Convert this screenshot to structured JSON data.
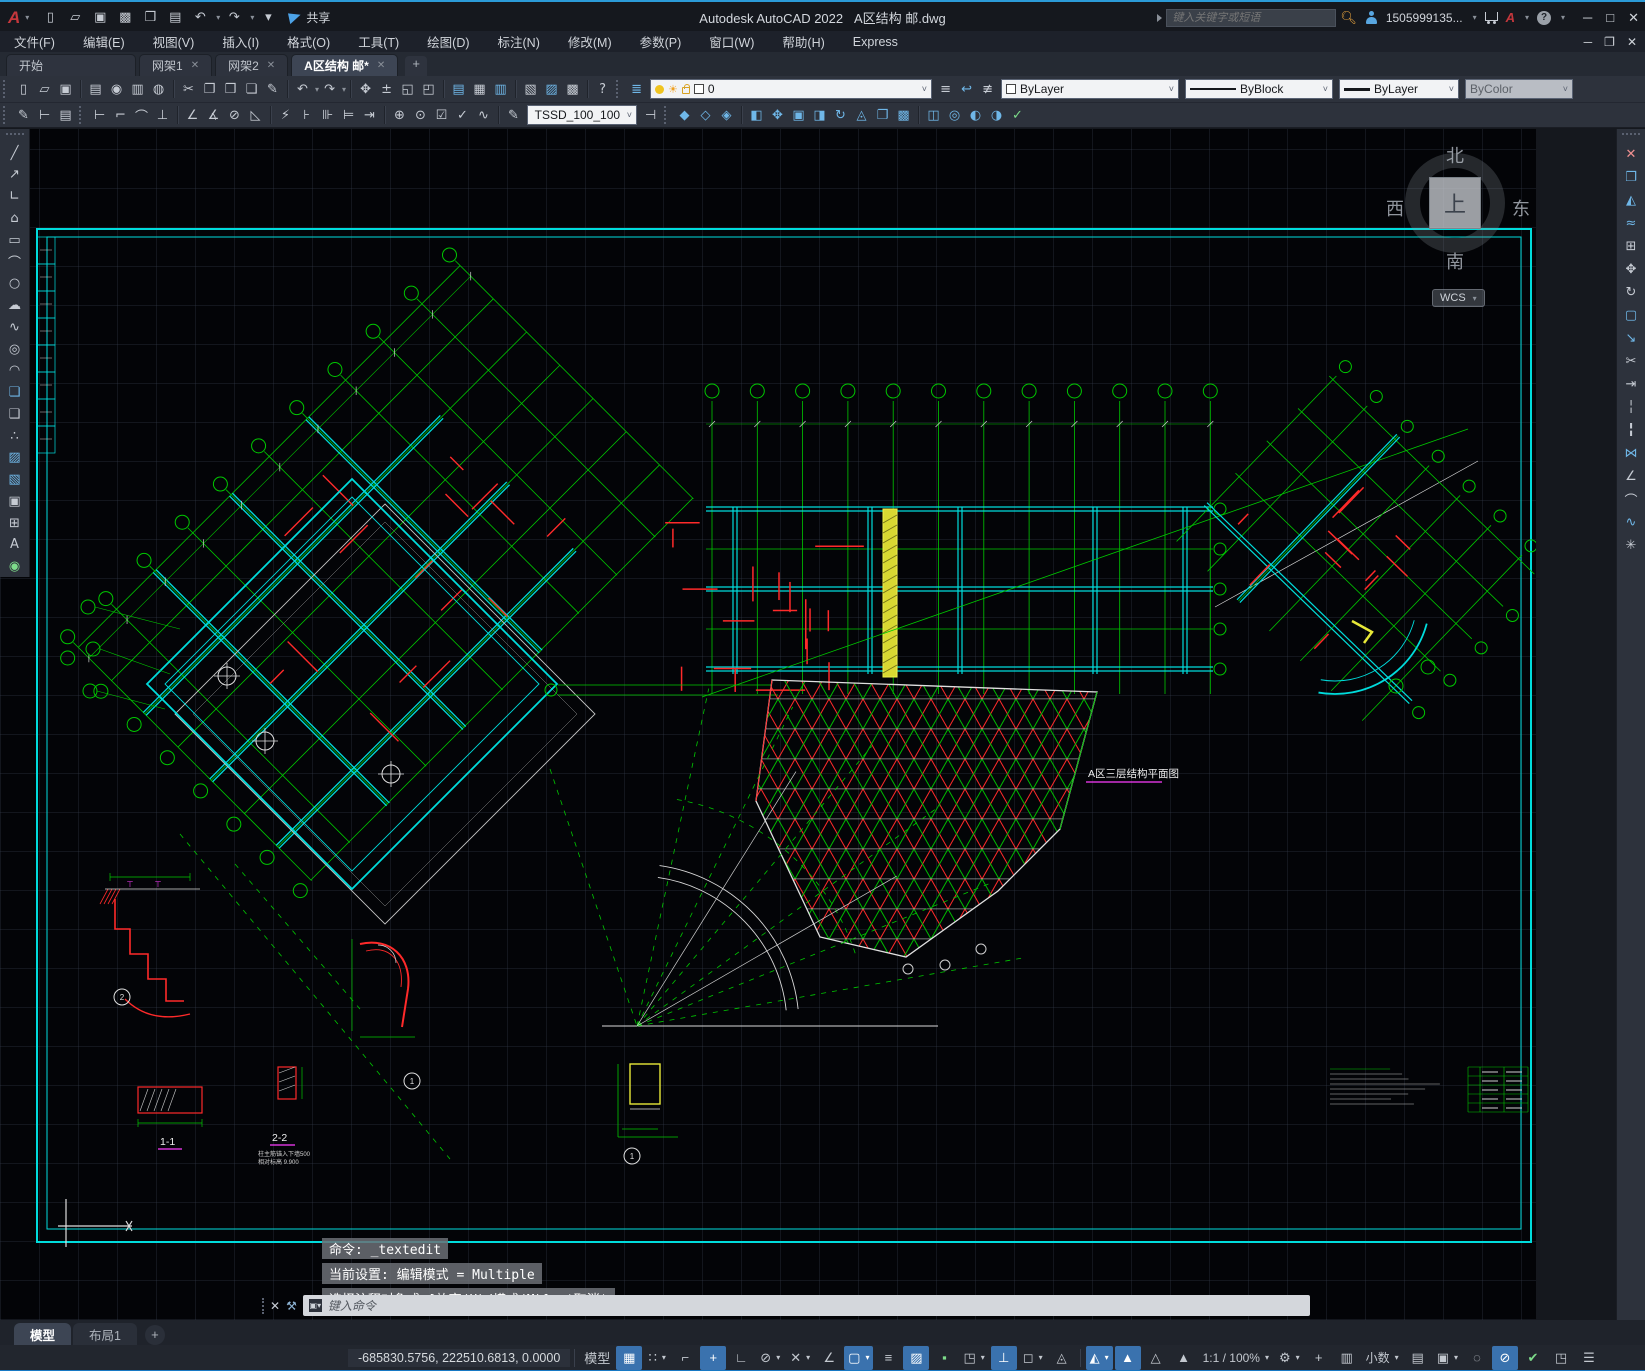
{
  "window": {
    "app_title": "Autodesk AutoCAD 2022",
    "doc_title": "A区结构 邮.dwg",
    "share_label": "共享",
    "search_placeholder": "键入关键字或短语",
    "account_label": "1505999135...",
    "min": "─",
    "max": "□",
    "close": "✕",
    "doc_restore": "❐"
  },
  "qat": [
    {
      "name": "new-icon",
      "glyph": "▯"
    },
    {
      "name": "open-icon",
      "glyph": "▱"
    },
    {
      "name": "save-icon",
      "glyph": "▣"
    },
    {
      "name": "save-as-icon",
      "glyph": "▩"
    },
    {
      "name": "open-web-mobile-icon",
      "glyph": "❒"
    },
    {
      "name": "plot-icon",
      "glyph": "▤"
    },
    {
      "name": "undo-icon",
      "glyph": "↶",
      "caret": true
    },
    {
      "name": "redo-icon",
      "glyph": "↷",
      "caret": true
    },
    {
      "name": "qat-customize-icon",
      "glyph": "▾"
    }
  ],
  "menubar": {
    "items": [
      "文件(F)",
      "编辑(E)",
      "视图(V)",
      "插入(I)",
      "格式(O)",
      "工具(T)",
      "绘图(D)",
      "标注(N)",
      "修改(M)",
      "参数(P)",
      "窗口(W)",
      "帮助(H)",
      "Express"
    ]
  },
  "file_tabs": {
    "tabs": [
      {
        "label": "开始",
        "closable": false,
        "active": false
      },
      {
        "label": "网架1",
        "closable": true,
        "active": false
      },
      {
        "label": "网架2",
        "closable": true,
        "active": false
      },
      {
        "label": "A区结构 邮*",
        "closable": true,
        "active": true
      }
    ],
    "add_label": "+"
  },
  "toolbar1": {
    "icons": [
      {
        "grip": true
      },
      {
        "name": "new-icon",
        "glyph": "▯"
      },
      {
        "name": "open-icon",
        "glyph": "▱"
      },
      {
        "name": "save-icon",
        "glyph": "▣"
      },
      {
        "sep": true
      },
      {
        "name": "print-icon",
        "glyph": "▤"
      },
      {
        "name": "print-preview-icon",
        "glyph": "◉"
      },
      {
        "name": "batch-plot-icon",
        "glyph": "▥"
      },
      {
        "name": "publish-icon",
        "glyph": "◍"
      },
      {
        "sep": true
      },
      {
        "name": "cut-icon",
        "glyph": "✂"
      },
      {
        "name": "copy-icon",
        "glyph": "❐"
      },
      {
        "name": "paste-icon",
        "glyph": "❒"
      },
      {
        "name": "copy-base-icon",
        "glyph": "❏"
      },
      {
        "name": "match-properties-icon",
        "glyph": "✎"
      },
      {
        "sep": true
      },
      {
        "name": "undo-icon",
        "glyph": "↶",
        "caret": true
      },
      {
        "name": "redo-icon",
        "glyph": "↷",
        "caret": true
      },
      {
        "sep": true
      },
      {
        "name": "pan-icon",
        "glyph": "✥"
      },
      {
        "name": "zoom-realtime-icon",
        "glyph": "±"
      },
      {
        "name": "zoom-window-icon",
        "glyph": "◱"
      },
      {
        "name": "zoom-previous-icon",
        "glyph": "◰"
      },
      {
        "sep": true
      },
      {
        "name": "properties-icon",
        "glyph": "▤",
        "blue": true
      },
      {
        "name": "designcenter-icon",
        "glyph": "▦"
      },
      {
        "name": "tool-palettes-icon",
        "glyph": "▥",
        "blue": true
      },
      {
        "sep": true
      },
      {
        "name": "sheet-set-icon",
        "glyph": "▧"
      },
      {
        "name": "markup-icon",
        "glyph": "▨",
        "blue": true
      },
      {
        "name": "quickcalc-icon",
        "glyph": "▩"
      },
      {
        "sep": true
      },
      {
        "name": "help-icon",
        "glyph": "?"
      },
      {
        "grip": true
      },
      {
        "name": "layer-properties-icon",
        "glyph": "≣",
        "blue": true
      }
    ],
    "layer_value": "0",
    "layer_state_icons": [
      {
        "name": "layer-previous-icon",
        "glyph": "≡"
      },
      {
        "name": "layer-states-icon",
        "glyph": "↩",
        "blue": true
      },
      {
        "name": "layer-isolate-icon",
        "glyph": "≢"
      }
    ],
    "color_value": "ByLayer",
    "linetype_value": "ByBlock",
    "lineweight_value": "ByLayer",
    "plotstyle_value": "ByColor"
  },
  "toolbar2": {
    "icons": [
      {
        "grip": true
      },
      {
        "name": "text-style-icon",
        "glyph": "✎"
      },
      {
        "name": "dim-style-icon",
        "glyph": "⊢"
      },
      {
        "name": "layer-translate-icon",
        "glyph": "▤"
      },
      {
        "grip": true
      },
      {
        "name": "dim-linear-icon",
        "glyph": "⊢"
      },
      {
        "name": "dim-aligned-icon",
        "glyph": "⌐"
      },
      {
        "name": "dim-arc-icon",
        "glyph": "⌒"
      },
      {
        "name": "dim-ordinate-icon",
        "glyph": "⊥"
      },
      {
        "sep": true
      },
      {
        "name": "dim-angular-icon",
        "glyph": "∠"
      },
      {
        "name": "dim-angular2-icon",
        "glyph": "∡"
      },
      {
        "name": "dim-diameter-icon",
        "glyph": "⊘"
      },
      {
        "name": "dim-radius-icon",
        "glyph": "◺"
      },
      {
        "sep": true
      },
      {
        "name": "dim-quick-icon",
        "glyph": "⚡"
      },
      {
        "name": "dim-baseline-icon",
        "glyph": "⊦"
      },
      {
        "name": "dim-continue-icon",
        "glyph": "⊪"
      },
      {
        "name": "dim-jog-icon",
        "glyph": "⊨"
      },
      {
        "name": "dim-break-icon",
        "glyph": "⇥"
      },
      {
        "sep": true
      },
      {
        "name": "dim-tolerance-icon",
        "glyph": "⊕"
      },
      {
        "name": "dim-center-icon",
        "glyph": "⊙"
      },
      {
        "name": "dim-inspect-icon",
        "glyph": "☑"
      },
      {
        "name": "dim-update-icon",
        "glyph": "✓"
      },
      {
        "name": "dim-jogged-icon",
        "glyph": "∿"
      },
      {
        "sep": true
      },
      {
        "name": "dim-edit-icon",
        "glyph": "✎"
      }
    ],
    "style_value": "TSSD_100_100",
    "after_combo_icons": [
      {
        "name": "dim-text-edit-icon",
        "glyph": "⊣"
      },
      {
        "grip": true
      },
      {
        "name": "union-icon",
        "glyph": "◆",
        "blue": true
      },
      {
        "name": "subtract-icon",
        "glyph": "◇",
        "blue": true
      },
      {
        "name": "intersect-icon",
        "glyph": "◈",
        "blue": true
      },
      {
        "sep": true
      },
      {
        "name": "extrude-faces-icon",
        "glyph": "◧",
        "blue": true
      },
      {
        "name": "move-faces-icon",
        "glyph": "✥",
        "blue": true
      },
      {
        "name": "offset-faces-icon",
        "glyph": "▣",
        "blue": true
      },
      {
        "name": "delete-faces-icon",
        "glyph": "◨",
        "blue": true
      },
      {
        "name": "rotate-faces-icon",
        "glyph": "↻",
        "blue": true
      },
      {
        "name": "taper-faces-icon",
        "glyph": "◬",
        "blue": true
      },
      {
        "name": "copy-faces-icon",
        "glyph": "❐",
        "blue": true
      },
      {
        "name": "color-faces-icon",
        "glyph": "▩",
        "blue": true
      },
      {
        "sep": true
      },
      {
        "name": "imprint-icon",
        "glyph": "◫",
        "blue": true
      },
      {
        "name": "clean-icon",
        "glyph": "◎",
        "blue": true
      },
      {
        "name": "separate-icon",
        "glyph": "◐",
        "blue": true
      },
      {
        "name": "shell-icon",
        "glyph": "◑",
        "blue": true
      },
      {
        "name": "check-icon",
        "glyph": "✓",
        "color": "#7ddc8a"
      }
    ]
  },
  "draw_toolbar": [
    {
      "name": "line-icon",
      "glyph": "╱"
    },
    {
      "name": "construction-line-icon",
      "glyph": "↗"
    },
    {
      "name": "polyline-icon",
      "glyph": "∟"
    },
    {
      "name": "polygon-icon",
      "glyph": "⌂"
    },
    {
      "name": "rectangle-icon",
      "glyph": "▭"
    },
    {
      "name": "arc-icon",
      "glyph": "⌒"
    },
    {
      "name": "circle-icon",
      "glyph": "○"
    },
    {
      "name": "revcloud-icon",
      "glyph": "☁"
    },
    {
      "name": "spline-icon",
      "glyph": "∿"
    },
    {
      "name": "ellipse-icon",
      "glyph": "◎"
    },
    {
      "name": "ellipse-arc-icon",
      "glyph": "◠"
    },
    {
      "name": "insert-block-icon",
      "glyph": "❏",
      "blue": true
    },
    {
      "name": "make-block-icon",
      "glyph": "❑"
    },
    {
      "name": "point-icon",
      "glyph": "∴"
    },
    {
      "name": "hatch-icon",
      "glyph": "▨",
      "blue": true
    },
    {
      "name": "gradient-icon",
      "glyph": "▧",
      "blue": true
    },
    {
      "name": "region-icon",
      "glyph": "▣"
    },
    {
      "name": "table-icon",
      "glyph": "⊞"
    },
    {
      "name": "mtext-icon",
      "glyph": "A"
    },
    {
      "name": "donut-icon",
      "glyph": "◉",
      "color": "#7ddc8a"
    }
  ],
  "modify_toolbar": [
    {
      "name": "erase-icon",
      "glyph": "✕",
      "color": "#f09090"
    },
    {
      "name": "copy-icon",
      "glyph": "❐",
      "blue": true
    },
    {
      "name": "mirror-icon",
      "glyph": "◭",
      "blue": true
    },
    {
      "name": "offset-icon",
      "glyph": "≈",
      "blue": true
    },
    {
      "name": "array-icon",
      "glyph": "⊞"
    },
    {
      "name": "move-icon",
      "glyph": "✥"
    },
    {
      "name": "rotate-icon",
      "glyph": "↻"
    },
    {
      "name": "scale-icon",
      "glyph": "▢",
      "blue": true
    },
    {
      "name": "stretch-icon",
      "glyph": "↘",
      "blue": true
    },
    {
      "name": "trim-icon",
      "glyph": "✂"
    },
    {
      "name": "extend-icon",
      "glyph": "⇥"
    },
    {
      "name": "break-point-icon",
      "glyph": "╎"
    },
    {
      "name": "break-icon",
      "glyph": "╏"
    },
    {
      "name": "join-icon",
      "glyph": "⋈",
      "blue": true
    },
    {
      "name": "chamfer-icon",
      "glyph": "∠"
    },
    {
      "name": "fillet-icon",
      "glyph": "⌒"
    },
    {
      "name": "blend-icon",
      "glyph": "∿",
      "blue": true
    },
    {
      "name": "explode-icon",
      "glyph": "✳"
    }
  ],
  "viewcube": {
    "n": "北",
    "s": "南",
    "e": "东",
    "w": "西",
    "top": "上",
    "wcs": "WCS"
  },
  "canvas": {
    "plan_label": "A区三层结构平面图",
    "labels": {
      "s11": "1-1",
      "s22": "2-2",
      "note1": "柱主筋锚入下墙500",
      "note2": "相对标高 9.900",
      "b1": "1",
      "b2": "2"
    }
  },
  "command": {
    "history": [
      "命令: _textedit",
      "当前设置: 编辑模式 = Multiple",
      "选择注释对象或 [放弃(U)/模式(M)]: *取消*"
    ],
    "placeholder": "键入命令"
  },
  "layout_tabs": {
    "tabs": [
      {
        "label": "模型",
        "active": true
      },
      {
        "label": "布局1",
        "active": false
      }
    ],
    "add_label": "+"
  },
  "statusbar": {
    "coords": "-685830.5756, 222510.6813, 0.0000",
    "model_label": "模型",
    "toggles_left": [
      {
        "name": "grid-toggle",
        "glyph": "▦",
        "active": true
      },
      {
        "name": "snap-mode-toggle",
        "glyph": "∷",
        "caret": true
      },
      {
        "name": "infer-constraints-toggle",
        "glyph": "⌐"
      },
      {
        "name": "dynamic-input-toggle",
        "glyph": "+",
        "active": true
      },
      {
        "name": "ortho-toggle",
        "glyph": "∟"
      },
      {
        "name": "polar-tracking-toggle",
        "glyph": "⊘",
        "caret": true
      },
      {
        "name": "object-snap-tracking-toggle",
        "glyph": "✕",
        "caret": true
      },
      {
        "name": "angle-override-toggle",
        "glyph": "∠"
      },
      {
        "name": "object-snap-toggle",
        "glyph": "▢",
        "active": true,
        "caret": true
      },
      {
        "name": "lineweight-toggle",
        "glyph": "≡"
      },
      {
        "name": "transparency-toggle",
        "glyph": "▨",
        "active": true
      },
      {
        "name": "selection-cycling-toggle",
        "glyph": "▪",
        "color": "#7ddc8a"
      },
      {
        "name": "3d-osnap-toggle",
        "glyph": "◳",
        "caret": true
      },
      {
        "name": "dynamic-ucs-toggle",
        "glyph": "⊥",
        "active": true
      },
      {
        "name": "selection-filter-toggle",
        "glyph": "◻",
        "caret": true
      },
      {
        "name": "gizmo-toggle",
        "glyph": "◬"
      }
    ],
    "toggles_right": [
      {
        "name": "annotation-monitor-toggle",
        "glyph": "◭",
        "active": true,
        "caret": true
      },
      {
        "name": "annotation-visibility-toggle",
        "glyph": "▲",
        "active": true
      },
      {
        "name": "annotation-autoscale-toggle",
        "glyph": "△"
      },
      {
        "name": "annotation-scale-icon",
        "glyph": "▲"
      },
      {
        "name": "annotation-scale-value",
        "text": "1:1 / 100%",
        "caret": true
      },
      {
        "name": "workspace-switch",
        "glyph": "⚙",
        "caret": true
      },
      {
        "name": "crosshair-toggle",
        "glyph": "+"
      },
      {
        "name": "units-icon",
        "glyph": "▥"
      },
      {
        "name": "units-value",
        "text": "小数",
        "caret": true
      },
      {
        "name": "quick-properties-toggle",
        "glyph": "▤"
      },
      {
        "name": "lock-ui-toggle",
        "glyph": "▣",
        "caret": true
      },
      {
        "name": "isolate-objects-toggle",
        "glyph": "◌"
      },
      {
        "name": "hardware-acceleration-toggle",
        "glyph": "⊘",
        "active": true
      },
      {
        "name": "graphics-performance-toggle",
        "glyph": "✔",
        "color": "#7ddc8a"
      },
      {
        "name": "clean-screen-toggle",
        "glyph": "◳"
      },
      {
        "name": "customize-toggle",
        "glyph": "☰"
      }
    ]
  }
}
